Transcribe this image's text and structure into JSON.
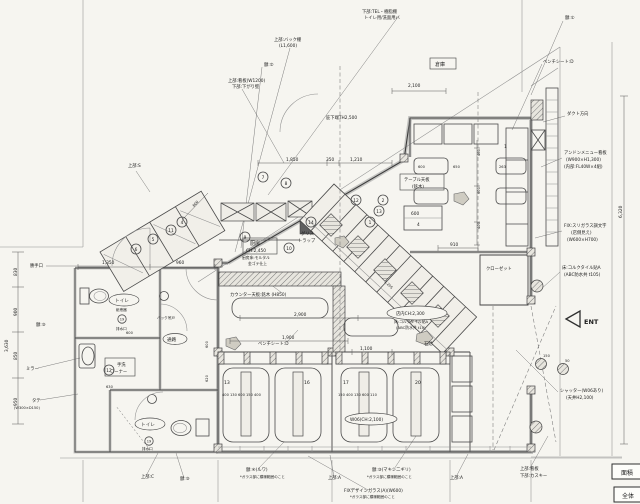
{
  "drawing": {
    "kind": "店舗平面図 (restaurant floor plan)",
    "paper": "#f6f5f0",
    "ink": "#3a3a3a",
    "wall": "#9a9a9a"
  },
  "notes": {
    "n0": "下部:TEL・樹脂棚",
    "n1": "トイレ用/洗面用バ",
    "n2": "上部:バック棚",
    "n3": "(L1,600)",
    "n4": "額:②",
    "n5": "上部:看板(W1200)",
    "n6": "下部:下がり壁",
    "n7": "倉庫",
    "n8": "額:①",
    "n9": "ベンチシート:D",
    "n10": "ダクト方向",
    "n11": "アンドンメニュー看板",
    "n12": "(W900×H1,300)",
    "n13": "(内部:FL40W×4組)",
    "n14": "FIX:スリガラス調文字",
    "n15": "(店側見え)",
    "n16": "(W600×H700)",
    "n17": "床:コルクタイル貼A",
    "n18": "(ABC防水共 t105)",
    "n19": "ENT",
    "n20": "シャッター(W06あり)",
    "n21": "(天井H2,100)",
    "n22": "上部:看板",
    "n23": "下部:カスキー",
    "n24": "上部:A",
    "n25": "額:③(マキシ二ギリ)",
    "n26": "*ガラス部に模様範囲のこと",
    "n27": "FIXデザインガラス(A)(W600)",
    "n28": "*ガラス部に模様範囲のこと",
    "n29": "上部:A",
    "n30": "額:④(ルワ)",
    "n31": "*ガラス部に模様範囲のこと",
    "n32": "上部:C",
    "n33": "額:⑤",
    "n34": "勝手口",
    "n35": "額:⑤",
    "n36": "ミラー",
    "n37": "タテ",
    "n38": "(W300×D150)",
    "n39": "トイレ",
    "n40": "紙巻器",
    "n41": "排水口",
    "n42": "手洗",
    "n43": "コーナー",
    "n44": "通路",
    "n45": "バック吊戸",
    "n46": "トイレ",
    "n47": "排水口",
    "n48": "厨房",
    "n49": "CH:2,450",
    "n50": "厨房床:モルタル",
    "n51": "金ゴテ仕上",
    "n52": "グリス",
    "n53": "トラップ",
    "n54": "カウンター天板:銘木 (H850)",
    "n55": "ベンチシート:D",
    "n56": "店内CH:2,300",
    "n57": "床:コルクタイル貼A",
    "n58": "(ABC防水共 t10)",
    "n59": "石貼",
    "n60": "クローゼット",
    "n61": "テーブル天板",
    "n62": "(銘木)",
    "n63": "上部:S",
    "n64": "W06(CH:2,100)",
    "n65": "庇下端TH2,500",
    "n66": "面積",
    "n67": "全体"
  },
  "dims": {
    "d0": "1,850",
    "d1": "350",
    "d2": "1,210",
    "d3": "2,100",
    "d4": "1,350",
    "d5": "960",
    "d6": "830",
    "d7": "900",
    "d8": "850",
    "d9": "950",
    "d10": "3,630",
    "d11": "6,320",
    "d12": "1,900",
    "d13": "2,900",
    "d14": "1,100",
    "d15": "400 130 600 150 400",
    "d16": "150 400 130 600 110",
    "d17": "910",
    "d18": "600",
    "d19": "4",
    "d20": "600",
    "d21": "650",
    "d22": "263",
    "d23": "1",
    "d24": "150",
    "d25": "50",
    "d26": "600",
    "d27": "620",
    "d28": "630",
    "d29": "600",
    "d30": "1,205",
    "d31": "600",
    "d32": "460",
    "d33": "600",
    "d34": "400",
    "d35": "13",
    "d36": "16",
    "d37": "17",
    "d38": "20"
  },
  "tags": {
    "t1": "1",
    "t2": "2",
    "t3": "13",
    "t4": "12",
    "t5": "14",
    "t6": "7",
    "t7": "8",
    "t8": "4",
    "t9": "11",
    "t10": "5",
    "t11": "6",
    "t12": "9",
    "t13": "10",
    "t14": "12",
    "t15": "19",
    "t16": "19"
  }
}
